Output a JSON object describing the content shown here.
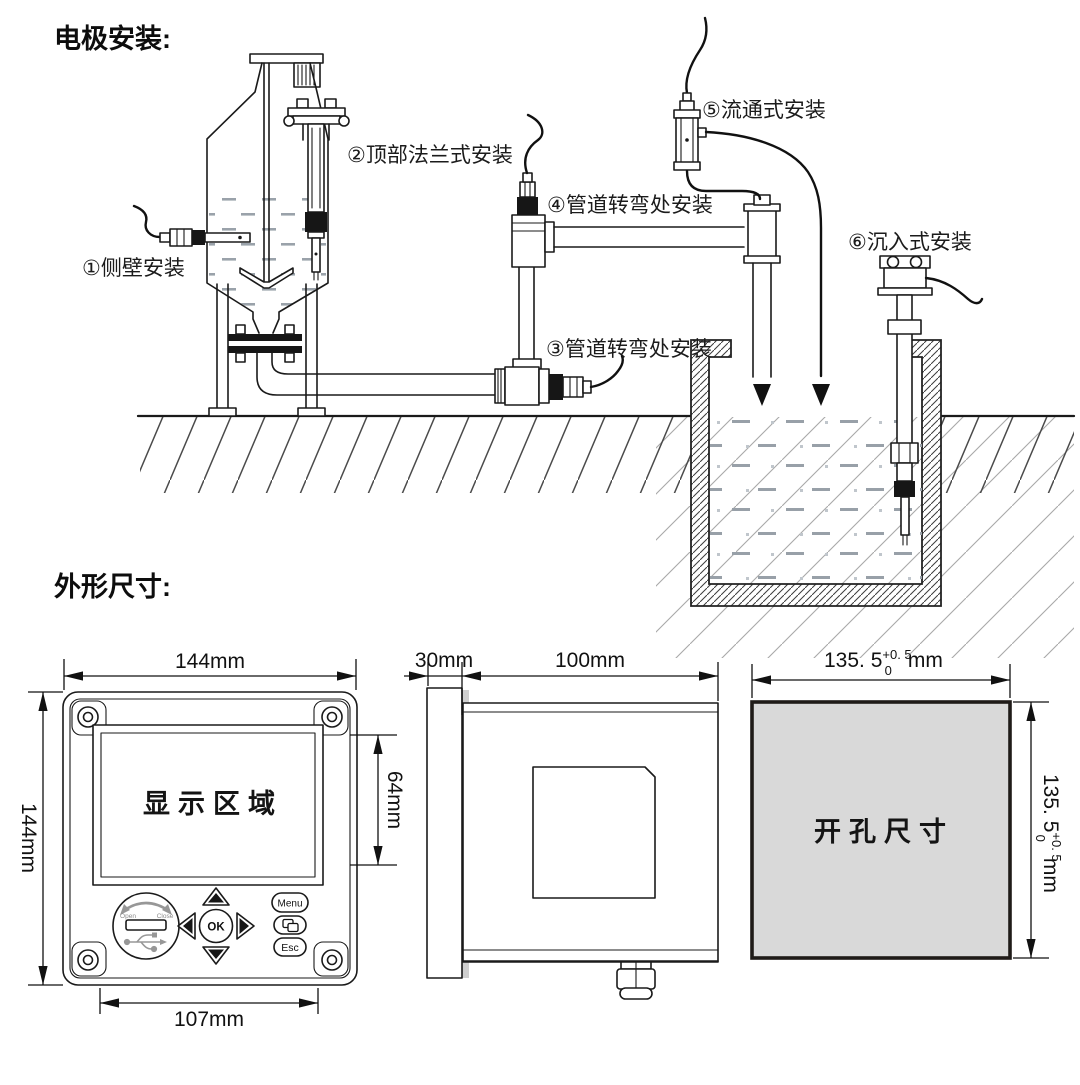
{
  "headings": {
    "electrode_install": "电极安装:",
    "outline_dimensions": "外形尺寸:"
  },
  "install_labels": {
    "n1": "①侧壁安装",
    "n2": "②顶部法兰式安装",
    "n3": "③管道转弯处安装",
    "n4": "④管道转弯处安装",
    "n5": "⑤流通式安装",
    "n6": "⑥沉入式安装"
  },
  "front_view": {
    "display_label": "显示区域",
    "dim_width": "144mm",
    "dim_height": "144mm",
    "dim_display_height": "64mm",
    "dim_keypad_width": "107mm",
    "keys": {
      "menu": "Menu",
      "esc": "Esc",
      "ok": "OK"
    },
    "usb": {
      "open": "Open",
      "close": "Close"
    }
  },
  "side_view": {
    "dim_bezel": "30mm",
    "dim_depth": "100mm"
  },
  "cutout": {
    "label": "开孔尺寸",
    "fill": "#d9d9d9",
    "dim_width": {
      "base": "135. 5",
      "sup": "+0. 5",
      "sub": "0",
      "unit": "mm"
    },
    "dim_height": {
      "base": "135. 5",
      "sup": "+0. 5",
      "sub": "0",
      "unit": "mm"
    }
  },
  "colors": {
    "line": "#1a1a1a",
    "water_dash": "#98a0a8",
    "soil_sparse": "#a8a8a8",
    "soil_dense": "#4a4a4a"
  }
}
